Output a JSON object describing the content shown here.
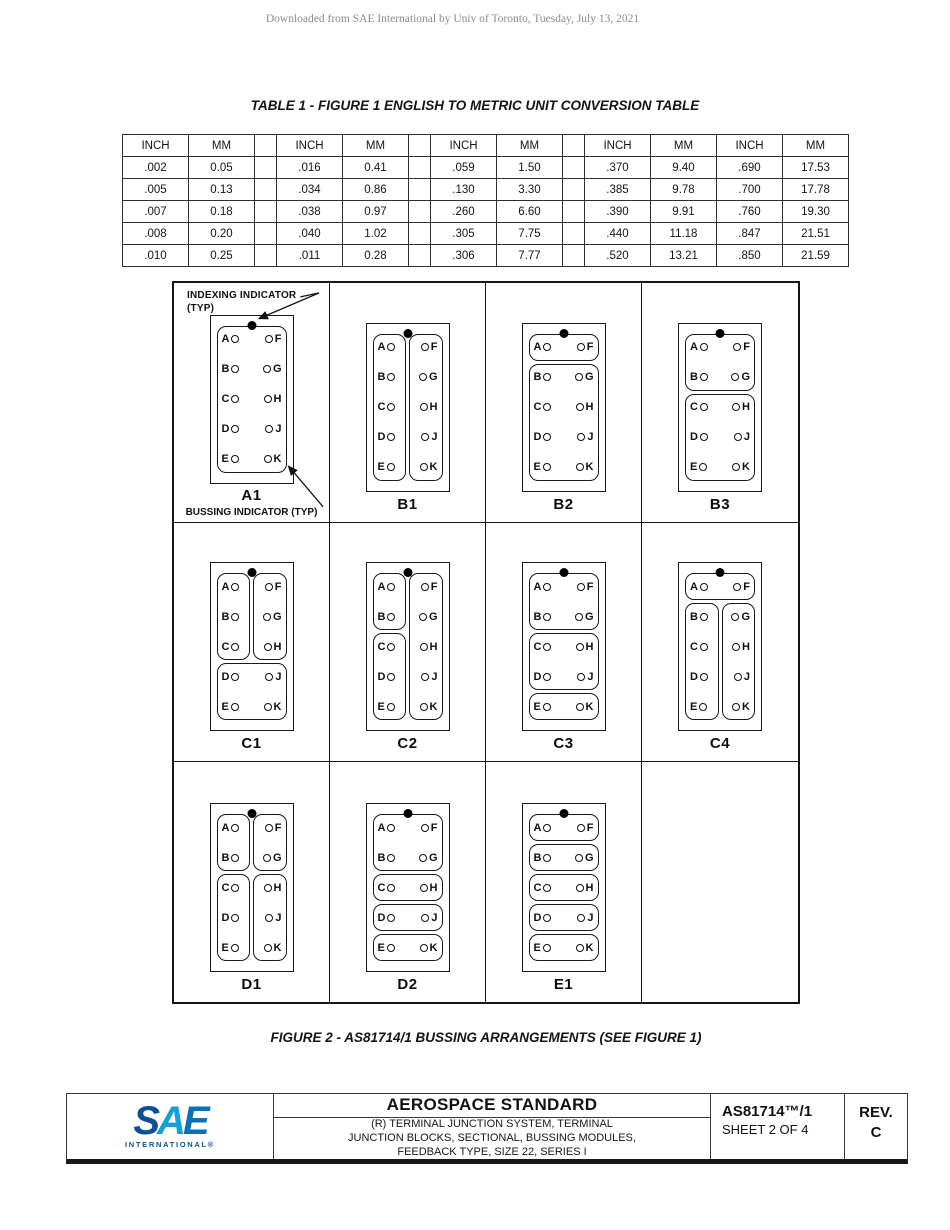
{
  "page": {
    "watermark": "Downloaded from SAE International by Univ of Toronto, Tuesday, July 13, 2021"
  },
  "table1": {
    "title": "TABLE 1 - FIGURE 1 ENGLISH TO METRIC UNIT CONVERSION TABLE",
    "headers": [
      "INCH",
      "MM",
      "",
      "INCH",
      "MM",
      "",
      "INCH",
      "MM",
      "",
      "INCH",
      "MM",
      "INCH",
      "MM"
    ],
    "rows": [
      [
        ".002",
        "0.05",
        "",
        ".016",
        "0.41",
        "",
        ".059",
        "1.50",
        "",
        ".370",
        "9.40",
        ".690",
        "17.53"
      ],
      [
        ".005",
        "0.13",
        "",
        ".034",
        "0.86",
        "",
        ".130",
        "3.30",
        "",
        ".385",
        "9.78",
        ".700",
        "17.78"
      ],
      [
        ".007",
        "0.18",
        "",
        ".038",
        "0.97",
        "",
        ".260",
        "6.60",
        "",
        ".390",
        "9.91",
        ".760",
        "19.30"
      ],
      [
        ".008",
        "0.20",
        "",
        ".040",
        "1.02",
        "",
        ".305",
        "7.75",
        "",
        ".440",
        "11.18",
        ".847",
        "21.51"
      ],
      [
        ".010",
        "0.25",
        "",
        ".011",
        "0.28",
        "",
        ".306",
        "7.77",
        "",
        ".520",
        "13.21",
        ".850",
        "21.59"
      ]
    ]
  },
  "figure2": {
    "caption": "FIGURE 2 - AS81714/1 BUSSING ARRANGEMENTS (SEE FIGURE 1)",
    "annotations": {
      "indexing_line1": "INDEXING INDICATOR",
      "indexing_line2": "(TYP)",
      "bussing": "BUSSING INDICATOR (TYP)"
    },
    "left_letters": [
      "A",
      "B",
      "C",
      "D",
      "E"
    ],
    "right_letters": [
      "F",
      "G",
      "H",
      "J",
      "K"
    ],
    "modules": [
      {
        "label": "A1",
        "groups": [
          {
            "r": 1,
            "c": 1,
            "rs": 5,
            "cs": 2
          }
        ]
      },
      {
        "label": "B1",
        "groups": [
          {
            "r": 1,
            "c": 1,
            "rs": 5,
            "cs": 1
          },
          {
            "r": 1,
            "c": 2,
            "rs": 5,
            "cs": 1
          }
        ]
      },
      {
        "label": "B2",
        "groups": [
          {
            "r": 1,
            "c": 1,
            "rs": 1,
            "cs": 2
          },
          {
            "r": 2,
            "c": 1,
            "rs": 4,
            "cs": 2
          }
        ]
      },
      {
        "label": "B3",
        "groups": [
          {
            "r": 1,
            "c": 1,
            "rs": 2,
            "cs": 2
          },
          {
            "r": 3,
            "c": 1,
            "rs": 3,
            "cs": 2
          }
        ]
      },
      {
        "label": "C1",
        "groups": [
          {
            "r": 1,
            "c": 1,
            "rs": 3,
            "cs": 1
          },
          {
            "r": 1,
            "c": 2,
            "rs": 3,
            "cs": 1
          },
          {
            "r": 4,
            "c": 1,
            "rs": 2,
            "cs": 2
          }
        ]
      },
      {
        "label": "C2",
        "groups": [
          {
            "r": 1,
            "c": 1,
            "rs": 2,
            "cs": 1
          },
          {
            "r": 3,
            "c": 1,
            "rs": 3,
            "cs": 1
          },
          {
            "r": 1,
            "c": 2,
            "rs": 5,
            "cs": 1
          }
        ]
      },
      {
        "label": "C3",
        "groups": [
          {
            "r": 1,
            "c": 1,
            "rs": 2,
            "cs": 2
          },
          {
            "r": 3,
            "c": 1,
            "rs": 2,
            "cs": 2
          },
          {
            "r": 5,
            "c": 1,
            "rs": 1,
            "cs": 2
          }
        ]
      },
      {
        "label": "C4",
        "groups": [
          {
            "r": 1,
            "c": 1,
            "rs": 1,
            "cs": 2
          },
          {
            "r": 2,
            "c": 1,
            "rs": 4,
            "cs": 1
          },
          {
            "r": 2,
            "c": 2,
            "rs": 4,
            "cs": 1
          }
        ]
      },
      {
        "label": "D1",
        "groups": [
          {
            "r": 1,
            "c": 1,
            "rs": 2,
            "cs": 1
          },
          {
            "r": 1,
            "c": 2,
            "rs": 2,
            "cs": 1
          },
          {
            "r": 3,
            "c": 1,
            "rs": 3,
            "cs": 1
          },
          {
            "r": 3,
            "c": 2,
            "rs": 3,
            "cs": 1
          }
        ]
      },
      {
        "label": "D2",
        "groups": [
          {
            "r": 1,
            "c": 1,
            "rs": 2,
            "cs": 2
          },
          {
            "r": 3,
            "c": 1,
            "rs": 1,
            "cs": 2
          },
          {
            "r": 4,
            "c": 1,
            "rs": 1,
            "cs": 2
          },
          {
            "r": 5,
            "c": 1,
            "rs": 1,
            "cs": 2
          }
        ]
      },
      {
        "label": "E1",
        "groups": [
          {
            "r": 1,
            "c": 1,
            "rs": 1,
            "cs": 2
          },
          {
            "r": 2,
            "c": 1,
            "rs": 1,
            "cs": 2
          },
          {
            "r": 3,
            "c": 1,
            "rs": 1,
            "cs": 2
          },
          {
            "r": 4,
            "c": 1,
            "rs": 1,
            "cs": 2
          },
          {
            "r": 5,
            "c": 1,
            "rs": 1,
            "cs": 2
          }
        ]
      }
    ]
  },
  "footer": {
    "logo": {
      "letters": [
        "S",
        "A",
        "E"
      ],
      "subtext": "INTERNATIONAL®"
    },
    "title": "AEROSPACE STANDARD",
    "subtitle_lines": [
      "(R) TERMINAL JUNCTION SYSTEM, TERMINAL",
      "JUNCTION BLOCKS, SECTIONAL, BUSSING MODULES,",
      "FEEDBACK TYPE, SIZE 22, SERIES I"
    ],
    "doc_number": "AS81714™/1",
    "sheet": "SHEET 2 OF 4",
    "rev_label": "REV.",
    "rev_value": "C",
    "colors": {
      "logo_dark": "#0d4f97",
      "logo_light": "#149fd8",
      "ink": "#141414"
    }
  }
}
